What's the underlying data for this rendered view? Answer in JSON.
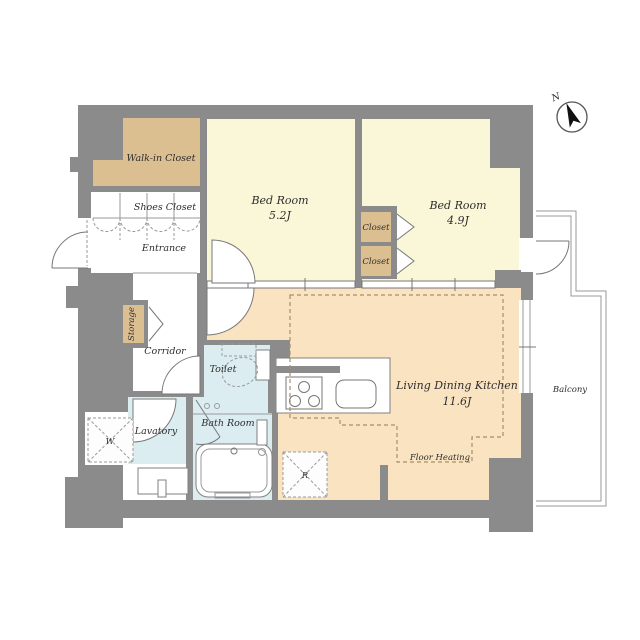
{
  "compass": {
    "north_label": "N"
  },
  "rooms": {
    "walk_in_closet": {
      "label": "Walk-in Closet"
    },
    "shoes_closet": {
      "label": "Shoes Closet"
    },
    "entrance": {
      "label": "Entrance"
    },
    "storage": {
      "label": "Storage"
    },
    "corridor": {
      "label": "Corridor"
    },
    "bedroom1": {
      "label": "Bed Room",
      "size": "5.2J"
    },
    "bedroom2": {
      "label": "Bed Room",
      "size": "4.9J"
    },
    "closet_upper": {
      "label": "Closet"
    },
    "closet_lower": {
      "label": "Closet"
    },
    "toilet": {
      "label": "Toilet"
    },
    "lavatory": {
      "label": "Lavatory"
    },
    "bathroom": {
      "label": "Bath Room"
    },
    "ldk": {
      "label": "Living Dining Kitchen",
      "size": "11.6J"
    },
    "floor_heating": {
      "label": "Floor Heating"
    },
    "balcony": {
      "label": "Balcony"
    }
  },
  "fixtures": {
    "washer_space": {
      "label": "W"
    },
    "refrigerator_space": {
      "label": "R"
    }
  },
  "colors": {
    "wall": "#8b8b8b",
    "bedroom_floor": "#faf7d8",
    "closet_floor": "#dcbf90",
    "ldk_floor": "#fae3c1",
    "wet_area_floor": "#dcedf2",
    "floor_heating_dash": "#a5906a"
  }
}
